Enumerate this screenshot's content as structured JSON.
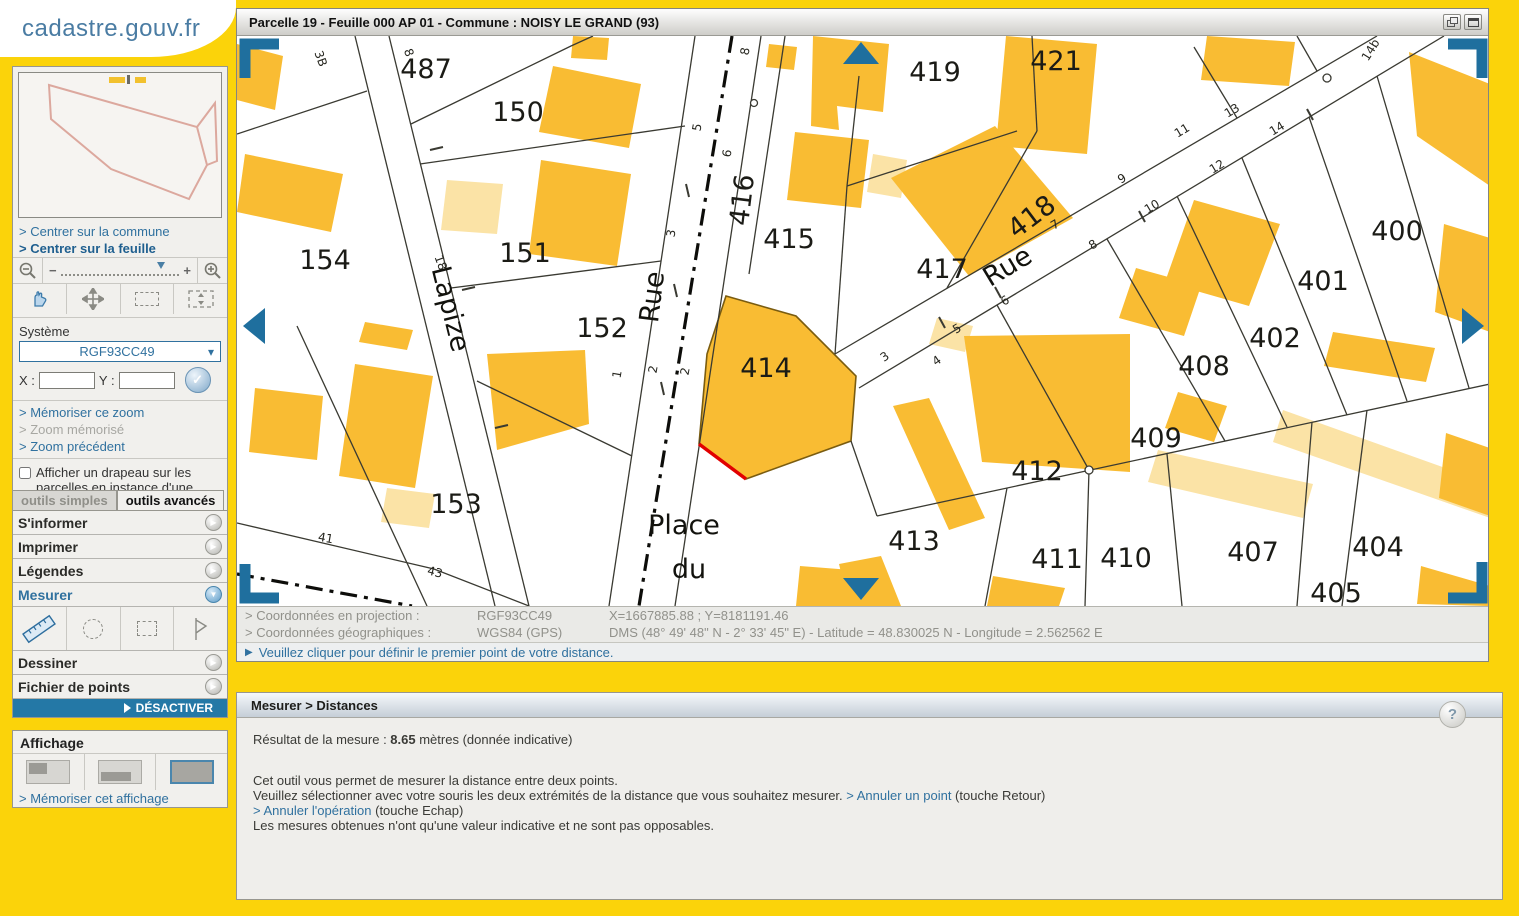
{
  "logo": {
    "title": "cadastre.gouv.fr"
  },
  "sidebar": {
    "center_commune": "> Centrer sur la commune",
    "center_feuille": "> Centrer sur la feuille",
    "system_label": "Système",
    "system_value": "RGF93CC49",
    "x_label": "X :",
    "y_label": "Y :",
    "check_label": "✓",
    "memorize_zoom": "> Mémoriser ce zoom",
    "zoom_memorized": "> Zoom mémorisé",
    "zoom_previous": "> Zoom précédent",
    "flag_checkbox": "Afficher un drapeau sur les parcelles en instance d'une mise à jour graphique",
    "tabs": [
      {
        "label": "outils simples"
      },
      {
        "label": "outils avancés"
      }
    ],
    "accordion": [
      {
        "label": "S'informer"
      },
      {
        "label": "Imprimer"
      },
      {
        "label": "Légendes"
      },
      {
        "label": "Mesurer"
      },
      {
        "label": "Dessiner"
      },
      {
        "label": "Fichier de points"
      }
    ],
    "deactivate": "DÉSACTIVER",
    "display_title": "Affichage",
    "memorize_display": "> Mémoriser cet affichage"
  },
  "map_window": {
    "title": "Parcelle 19 - Feuille 000 AP 01 - Commune : NOISY LE GRAND (93)"
  },
  "map": {
    "parcel_labels": [
      {
        "t": "487",
        "x": 189,
        "y": 42
      },
      {
        "t": "150",
        "x": 281,
        "y": 85
      },
      {
        "t": "151",
        "x": 288,
        "y": 226
      },
      {
        "t": "152",
        "x": 365,
        "y": 301
      },
      {
        "t": "153",
        "x": 219,
        "y": 477
      },
      {
        "t": "154",
        "x": 88,
        "y": 233
      },
      {
        "t": "414",
        "x": 529,
        "y": 341
      },
      {
        "t": "415",
        "x": 552,
        "y": 212
      },
      {
        "t": "416",
        "x": 514,
        "y": 165,
        "r": -83
      },
      {
        "t": "417",
        "x": 705,
        "y": 242
      },
      {
        "t": "418",
        "x": 800,
        "y": 188,
        "r": -37
      },
      {
        "t": "419",
        "x": 698,
        "y": 45
      },
      {
        "t": "421",
        "x": 819,
        "y": 34
      },
      {
        "t": "400",
        "x": 1160,
        "y": 204
      },
      {
        "t": "401",
        "x": 1086,
        "y": 254
      },
      {
        "t": "402",
        "x": 1038,
        "y": 311
      },
      {
        "t": "408",
        "x": 967,
        "y": 339
      },
      {
        "t": "409",
        "x": 919,
        "y": 411
      },
      {
        "t": "412",
        "x": 800,
        "y": 444
      },
      {
        "t": "413",
        "x": 677,
        "y": 514
      },
      {
        "t": "411",
        "x": 820,
        "y": 532
      },
      {
        "t": "410",
        "x": 889,
        "y": 531
      },
      {
        "t": "407",
        "x": 1016,
        "y": 525
      },
      {
        "t": "404",
        "x": 1141,
        "y": 520
      },
      {
        "t": "405",
        "x": 1099,
        "y": 566
      }
    ],
    "street_labels": [
      {
        "t": "Lapize",
        "x": 205,
        "y": 275,
        "r": 76
      },
      {
        "t": "Rue",
        "x": 424,
        "y": 262,
        "r": -83
      },
      {
        "t": "Rue",
        "x": 775,
        "y": 238,
        "r": -31
      },
      {
        "t": "Place",
        "x": 447,
        "y": 498
      },
      {
        "t": "du",
        "x": 452,
        "y": 542
      }
    ],
    "lot_numbers": [
      {
        "t": "3B",
        "x": 80,
        "y": 24,
        "r": 70
      },
      {
        "t": "8",
        "x": 168,
        "y": 18,
        "r": 70
      },
      {
        "t": "18",
        "x": 200,
        "y": 228,
        "r": 70
      },
      {
        "t": "41",
        "x": 88,
        "y": 506,
        "r": 10
      },
      {
        "t": "43",
        "x": 197,
        "y": 540,
        "r": 14
      },
      {
        "t": "8",
        "x": 512,
        "y": 16,
        "r": -80
      },
      {
        "t": "5",
        "x": 464,
        "y": 92,
        "r": -80
      },
      {
        "t": "6",
        "x": 494,
        "y": 118,
        "r": -80
      },
      {
        "t": "3",
        "x": 438,
        "y": 198,
        "r": -80
      },
      {
        "t": "1",
        "x": 384,
        "y": 339,
        "r": -80
      },
      {
        "t": "2",
        "x": 420,
        "y": 334,
        "r": -80
      },
      {
        "t": "2",
        "x": 452,
        "y": 336,
        "r": -80
      },
      {
        "t": "3",
        "x": 650,
        "y": 324,
        "r": -35
      },
      {
        "t": "4",
        "x": 702,
        "y": 328,
        "r": -35
      },
      {
        "t": "5",
        "x": 722,
        "y": 296,
        "r": -31
      },
      {
        "t": "6",
        "x": 770,
        "y": 268,
        "r": -31
      },
      {
        "t": "7",
        "x": 820,
        "y": 192,
        "r": -31
      },
      {
        "t": "8",
        "x": 858,
        "y": 212,
        "r": -31
      },
      {
        "t": "9",
        "x": 887,
        "y": 146,
        "r": -31
      },
      {
        "t": "10",
        "x": 917,
        "y": 174,
        "r": -31
      },
      {
        "t": "11",
        "x": 947,
        "y": 98,
        "r": -31
      },
      {
        "t": "12",
        "x": 982,
        "y": 134,
        "r": -31
      },
      {
        "t": "13",
        "x": 997,
        "y": 78,
        "r": -31
      },
      {
        "t": "14",
        "x": 1042,
        "y": 96,
        "r": -31
      },
      {
        "t": "14b",
        "x": 1137,
        "y": 16,
        "r": -58
      }
    ]
  },
  "coordinates": {
    "proj_label": "> Coordonnées en projection :",
    "proj_system": "RGF93CC49",
    "proj_value": "X=1667885.88 ; Y=8181191.46",
    "geo_label": "> Coordonnées géographiques :",
    "geo_system": "WGS84 (GPS)",
    "geo_value": "DMS (48° 49' 48\" N - 2° 33' 45\" E) - Latitude = 48.830025 N - Longitude = 2.562562 E",
    "instruction": "Veuillez cliquer pour définir le premier point de votre distance."
  },
  "measure_panel": {
    "header": "Mesurer > Distances",
    "result_prefix": "Résultat de la mesure : ",
    "result_value": "8.65",
    "result_suffix": " mètres (donnée indicative)",
    "line1": "Cet outil vous permet de mesurer la distance entre deux points.",
    "line2": "Veuillez sélectionner avec votre souris les deux extrémités de la distance que vous souhaitez mesurer. ",
    "cancel_point_link": "> Annuler un point",
    "cancel_point_suffix": " (touche Retour)",
    "cancel_op_link": "> Annuler l'opération",
    "cancel_op_suffix": " (touche Echap)",
    "line3": "Les mesures obtenues n'ont qu'une valeur indicative et ne sont pas opposables."
  },
  "colors": {
    "page_yellow": "#FBD30A",
    "building_orange": "#F9BC33",
    "building_light": "#FBE3A6",
    "accent_blue": "#30719F",
    "nav_blue": "#1F6F9E",
    "steel_blue": "#2478A6",
    "measure_red": "#E10000"
  }
}
